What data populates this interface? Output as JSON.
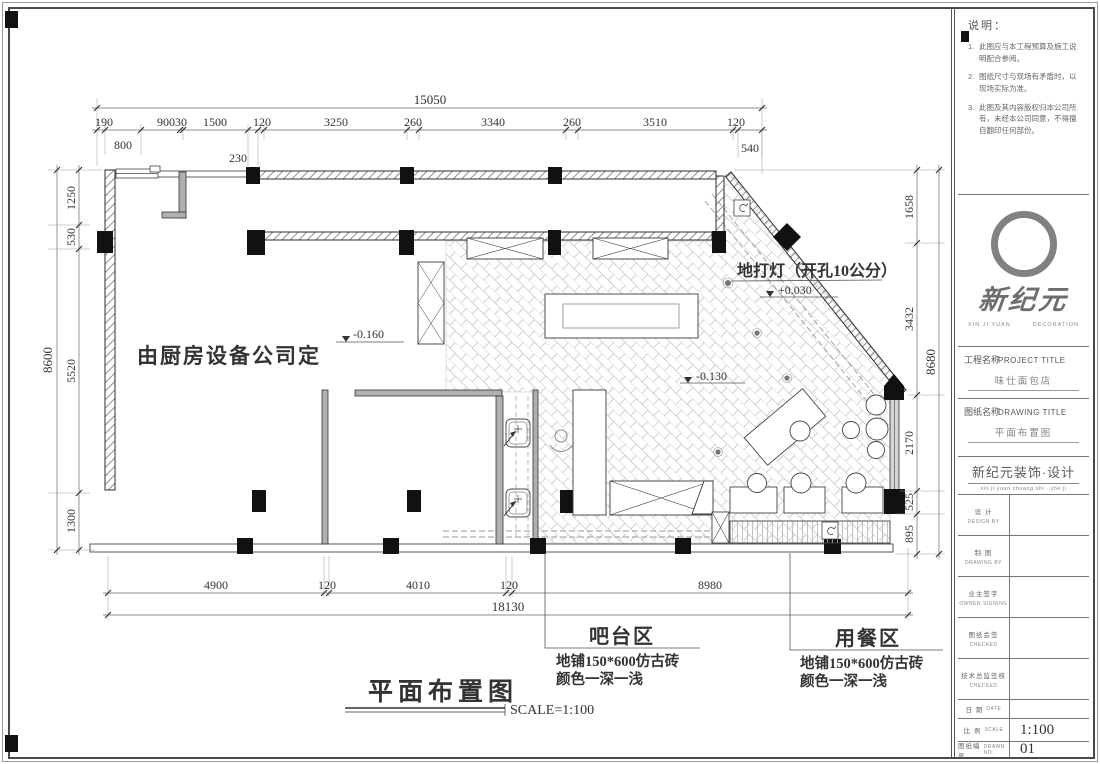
{
  "dims": {
    "top_total": "15050",
    "top_chain": [
      "190",
      "90030",
      "1500",
      "120",
      "3250",
      "260",
      "3340",
      "260",
      "3510",
      "120"
    ],
    "top_sub": [
      "800",
      "230",
      "540"
    ],
    "left_total": "8600",
    "left_chain": [
      "1250",
      "530",
      "5520",
      "1300"
    ],
    "right_total": "8680",
    "right_chain": [
      "1658",
      "3432",
      "2170",
      "525",
      "895"
    ],
    "bottom_total": "18130",
    "bottom_chain": [
      "4900",
      "120",
      "4010",
      "120",
      "8980"
    ]
  },
  "plan": {
    "kitchen_note": "由厨房设备公司定",
    "floor_light_note": "地打灯（开孔10公分）",
    "level_entry": "+0.030",
    "level_floor": "-0.130",
    "level_kitchen": "-0.160",
    "bar": {
      "name": "吧台区",
      "desc1": "地铺150*600仿古砖",
      "desc2": "颜色一深一浅"
    },
    "dining": {
      "name": "用餐区",
      "desc1": "地铺150*600仿古砖",
      "desc2": "颜色一深一浅"
    },
    "title": "平面布置图",
    "scale": "SCALE=1:100"
  },
  "titleblock": {
    "notes_title": "说明：",
    "notes": [
      {
        "no": "1.",
        "text": "此图应与本工程预算及施工说明配合参阅。"
      },
      {
        "no": "2.",
        "text": "图纸尺寸与现场有矛盾时，以现场实际为准。"
      },
      {
        "no": "3.",
        "text": "此图及其内容版权归本公司所有，未经本公司同意，不得擅自翻印任何部份。"
      }
    ],
    "logo": {
      "name": "新纪元",
      "sub_left": "XIN JI YUAN",
      "sub_right": "DECORATION"
    },
    "project": {
      "label": "工程名称",
      "label_en": "PROJECT TITLE",
      "value": "味仕面包店"
    },
    "drawing": {
      "label": "图纸名称",
      "label_en": "DRAWING TITLE",
      "value": "平面布置图"
    },
    "company": {
      "name": "新纪元装饰·设计",
      "pinyin": "xin ji yuan zhuang shi · she ji"
    },
    "rows": [
      {
        "label": "设 计",
        "en": "DESIGN BY",
        "value": ""
      },
      {
        "label": "制 图",
        "en": "DRAWING BY",
        "value": ""
      },
      {
        "label": "业主签字",
        "en": "OWNER SIGNING",
        "value": ""
      },
      {
        "label": "图纸会签",
        "en": "CHECKED",
        "value": ""
      },
      {
        "label": "技术总监签核",
        "en": "CHECKED",
        "value": ""
      }
    ],
    "date": {
      "label": "日 期",
      "en": "DATE",
      "value": ""
    },
    "scale": {
      "label": "比 例",
      "en": "SCALE",
      "value": "1:100"
    },
    "number": {
      "label": "图纸编号",
      "en": "DRAWN NO.",
      "value": "01"
    }
  }
}
